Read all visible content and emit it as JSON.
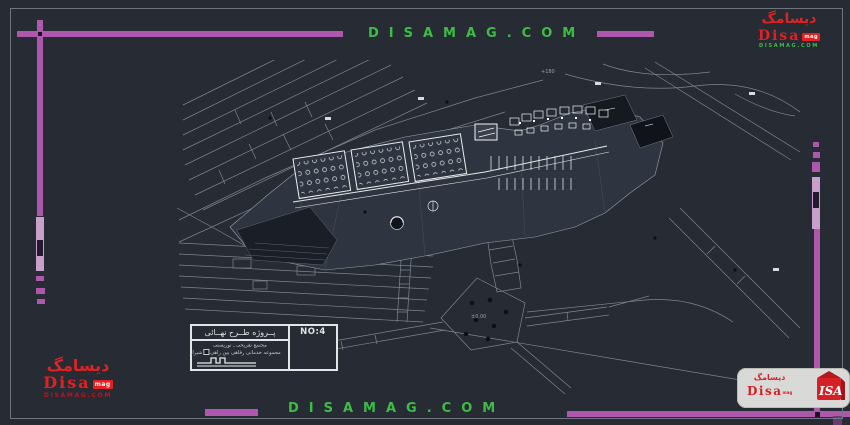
{
  "watermark": {
    "text_top": "DISAMAG.COM",
    "text_bottom": "DISAMAG.COM"
  },
  "logo_small": {
    "persian": "دیسامگ",
    "name": "Disa",
    "badge": "mag",
    "site": "DISAMAG.COM"
  },
  "logo_card": {
    "persian": "دیسامگ",
    "name": "Disa",
    "badge": "mag",
    "cube": "ISA"
  },
  "title_block": {
    "project": "پــروژه طــرح نهــائی",
    "number": "NO:4",
    "note1": "مجتمع تفریحی ـ توریستی",
    "note2_a": "مجموعه خدماتی رفاهی بین راهی",
    "note2_b": "شیراز"
  },
  "drawing_labels": {
    "spot1": "+180",
    "spot2": "±0.00"
  },
  "colors": {
    "background": "#262b34",
    "magenta": "#ad58ad",
    "magenta_light": "#c9a0c9",
    "green": "#3dbd45",
    "red": "#e32120",
    "line_gray": "#7f8690",
    "white": "#e8e9ea"
  }
}
